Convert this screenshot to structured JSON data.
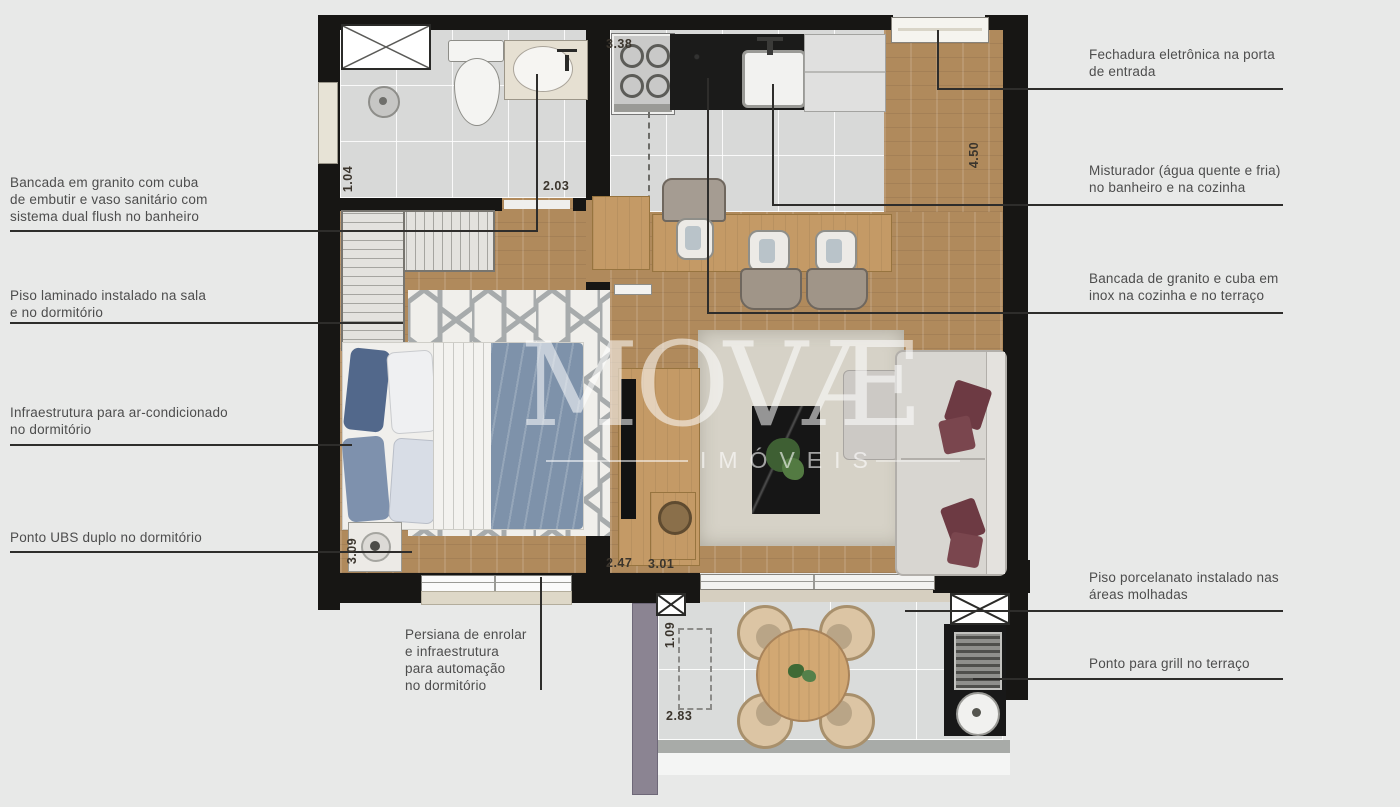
{
  "watermark": {
    "brand": "MOVÆ",
    "subtitle": "IMÓVEIS"
  },
  "annotations": {
    "left": [
      {
        "id": "bancada-banheiro",
        "text": "Bancada em granito com cuba\nde embutir e vaso sanitário com\nsistema dual flush no banheiro"
      },
      {
        "id": "piso-laminado",
        "text": "Piso laminado instalado na sala\ne no dormitório"
      },
      {
        "id": "ar-condicionado",
        "text": "Infraestrutura para ar-condicionado\nno dormitório"
      },
      {
        "id": "ponto-ubs",
        "text": "Ponto UBS duplo no dormitório"
      },
      {
        "id": "persiana",
        "text": "Persiana de enrolar\ne infraestrutura\npara automação\nno dormitório"
      }
    ],
    "right": [
      {
        "id": "fechadura",
        "text": "Fechadura eletrônica na porta\nde entrada"
      },
      {
        "id": "misturador",
        "text": "Misturador (água quente e fria)\nno banheiro e na cozinha"
      },
      {
        "id": "bancada-cozinha",
        "text": "Bancada de granito e cuba em\ninox na cozinha e no terraço"
      },
      {
        "id": "piso-porcelanato",
        "text": "Piso porcelanato instalado nas\náreas molhadas"
      },
      {
        "id": "ponto-grill",
        "text": "Ponto para grill no terraço"
      }
    ]
  },
  "dimensions": [
    {
      "label": "1.04"
    },
    {
      "label": "2.03"
    },
    {
      "label": "3.38"
    },
    {
      "label": "4.50"
    },
    {
      "label": "3.09"
    },
    {
      "label": "2.47"
    },
    {
      "label": "3.01"
    },
    {
      "label": "1.09"
    },
    {
      "label": "2.83"
    }
  ],
  "colors": {
    "background": "#e8e9e8",
    "wall": "#171614",
    "wood_floor": "#b08a5c",
    "tile_floor": "#d8d9d8",
    "granite_counter": "#1b1b1a",
    "duvet_blue": "#7e92aa",
    "sofa_pillow_maroon": "#6d3a43",
    "annotation_text": "#4d4d4d",
    "watermark_white": "rgba(255,255,255,0.55)"
  }
}
